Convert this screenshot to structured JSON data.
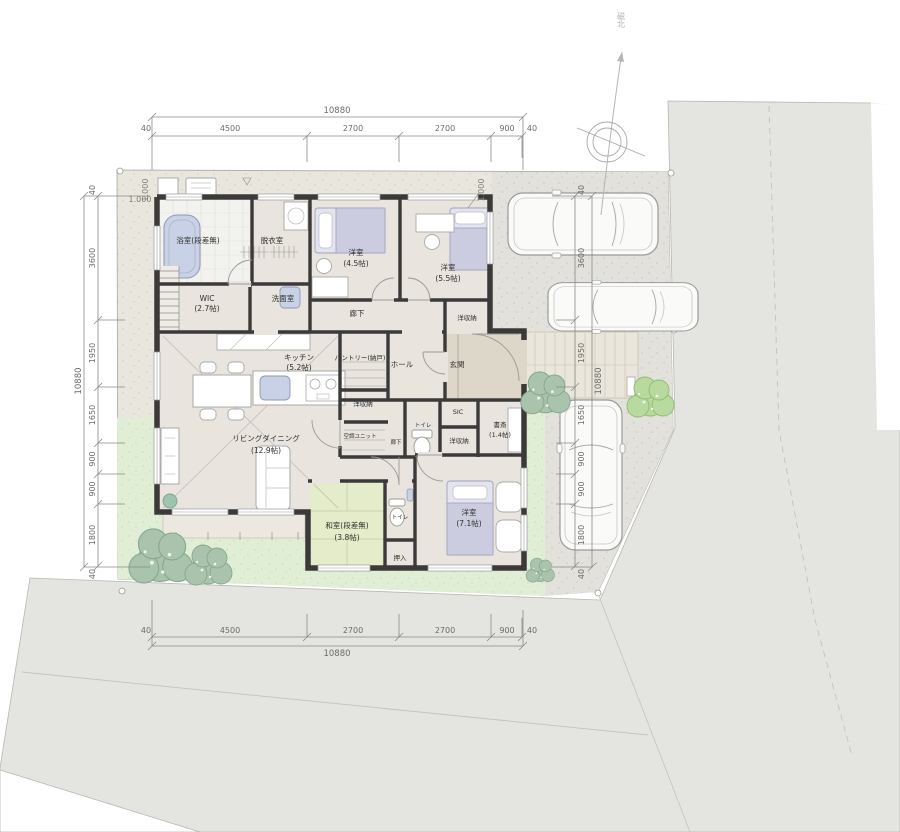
{
  "site": {
    "compass_label": "磁北",
    "elevation_labels": [
      "1.000",
      "1.000",
      "1.000"
    ]
  },
  "dimensions": {
    "top": {
      "total": "10880",
      "segments": [
        "40",
        "4500",
        "2700",
        "2700",
        "900",
        "40"
      ]
    },
    "bottom": {
      "total": "10880",
      "segments": [
        "40",
        "4500",
        "2700",
        "2700",
        "900",
        "40"
      ]
    },
    "left": {
      "total": "10880",
      "segments": [
        "40",
        "3600",
        "1950",
        "1650",
        "900",
        "900",
        "1800",
        "40"
      ]
    },
    "right": {
      "total": "10880",
      "segments": [
        "40",
        "3600",
        "1950",
        "1650",
        "900",
        "900",
        "1800",
        "40"
      ]
    }
  },
  "rooms": {
    "bath": {
      "label": "浴室(段差無)"
    },
    "dressing": {
      "label": "脱衣室"
    },
    "bedroom_45": {
      "label": "洋室",
      "size": "(4.5帖)"
    },
    "bedroom_55": {
      "label": "洋室",
      "size": "(5.5帖)"
    },
    "wic": {
      "label": "WIC",
      "size": "(2.7帖)"
    },
    "washroom": {
      "label": "洗面室"
    },
    "corridor": {
      "label": "廊下"
    },
    "closet_north": {
      "label": "洋収納"
    },
    "kitchen": {
      "label": "キッチン",
      "size": "(5.2帖)"
    },
    "pantry": {
      "label": "パントリー(納戸)"
    },
    "hall": {
      "label": "ホール"
    },
    "entrance": {
      "label": "玄関"
    },
    "closet_center": {
      "label": "洋収納"
    },
    "ac_unit": {
      "label": "空調ユニット"
    },
    "corridor_south": {
      "label": "廊下"
    },
    "toilet_north": {
      "label": "トイレ"
    },
    "sic": {
      "label": "SIC"
    },
    "closet_east": {
      "label": "洋収納"
    },
    "study": {
      "label": "書斎",
      "size": "(1.4帖)"
    },
    "living_dining": {
      "label": "リビングダイニング",
      "size": "(12.9帖)"
    },
    "japanese_room": {
      "label": "和室(段差無)",
      "size": "(3.8帖)"
    },
    "oshiire": {
      "label": "押入"
    },
    "toilet_south": {
      "label": "トイレ"
    },
    "bedroom_71": {
      "label": "洋室",
      "size": "(7.1帖)"
    }
  },
  "colors": {
    "wall": "#3b3a38",
    "floor": "#e9e5de",
    "tatami": "#e4ecca",
    "lawn": "#dfeed4",
    "concrete": "#e2e1dc",
    "road": "#e4e4e1",
    "water_fixture": "#c8d1e5",
    "bedding": "#cbccdf",
    "tree_sage": "#aac3ad",
    "tree_green": "#b9da9e"
  }
}
